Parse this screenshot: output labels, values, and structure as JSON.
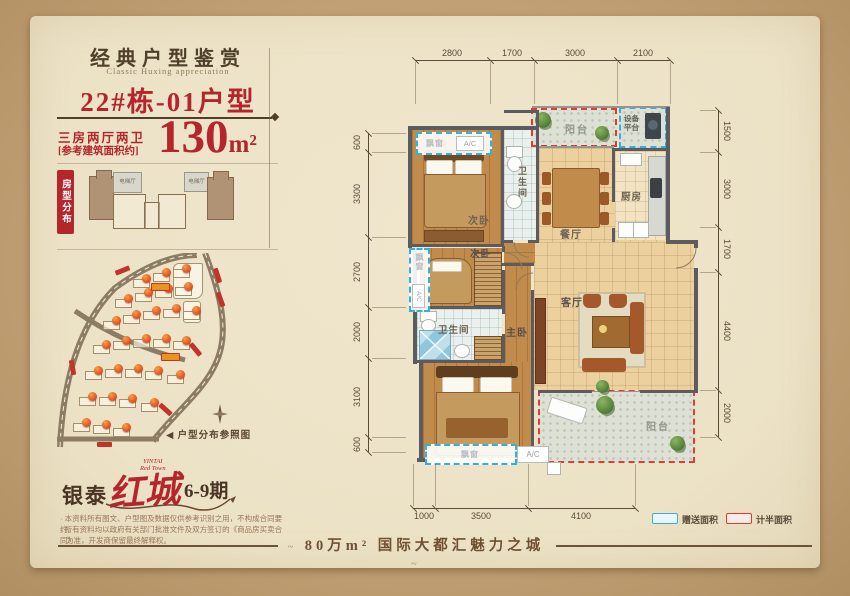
{
  "colors": {
    "accent_red": "#b5262c",
    "cyan_dash": "#34b0da",
    "red_dash": "#e23b2f",
    "panel": "#ece2c6",
    "kraft": "#c2a176"
  },
  "header": {
    "title": "经典户型鉴赏",
    "subtitle": "Classic Huxing appreciation",
    "unit_name": "22#栋-01户型"
  },
  "spec": {
    "layout": "三房两厅两卫",
    "area_note": "[参考建筑面积约]",
    "area_value": "130",
    "area_unit": "m²"
  },
  "distribution": {
    "label": "房型分布",
    "elevator": "电梯厅"
  },
  "site_map": {
    "caption": "◀ 户型分布参照图",
    "compass": "N",
    "buildings": [
      [
        78,
        26
      ],
      [
        98,
        20
      ],
      [
        118,
        16
      ],
      [
        60,
        46
      ],
      [
        80,
        40
      ],
      [
        100,
        36
      ],
      [
        120,
        34
      ],
      [
        48,
        68
      ],
      [
        68,
        62
      ],
      [
        88,
        58
      ],
      [
        108,
        56
      ],
      [
        128,
        58
      ],
      [
        38,
        92
      ],
      [
        58,
        88
      ],
      [
        78,
        86
      ],
      [
        98,
        86
      ],
      [
        118,
        88
      ],
      [
        30,
        118
      ],
      [
        50,
        116
      ],
      [
        70,
        116
      ],
      [
        90,
        118
      ],
      [
        112,
        122
      ],
      [
        24,
        144
      ],
      [
        44,
        144
      ],
      [
        64,
        146
      ],
      [
        86,
        150
      ],
      [
        18,
        170
      ],
      [
        38,
        172
      ],
      [
        58,
        175
      ]
    ]
  },
  "logo": {
    "brand": "银泰",
    "name": "红城",
    "phase": "6-9期",
    "en_line1": "YINTAI",
    "en_line2": "Red Town"
  },
  "disclaimer": {
    "line1": "· 本资料所有图文、户型图及数据仅供参考识别之用，不构成合同要约。",
    "line2": "· 所有资料均以政府有关部门批准文件及双方签订的《商品房买卖合同》",
    "line3": "为准，开发商保留最终解释权。"
  },
  "tagline": {
    "text": "80万m² 国际大都汇魅力之城",
    "flourish_left": "~",
    "flourish_right": "~"
  },
  "plan": {
    "dims": {
      "top": [
        "2800",
        "1700",
        "3000",
        "2100"
      ],
      "right": [
        "1500",
        "3000",
        "1700",
        "4400",
        "2000"
      ],
      "left": [
        "600",
        "3300",
        "2700",
        "2000",
        "3100",
        "600"
      ],
      "bottom": [
        "1000",
        "3500",
        "4100"
      ]
    },
    "rooms": {
      "balcony": "阳台",
      "equipment_line1": "设备",
      "equipment_line2": "平台",
      "kitchen": "厨房",
      "dining": "餐厅",
      "living": "客厅",
      "bedroom": "次卧",
      "master": "主卧",
      "bath": "卫生间",
      "bay_window": "飘窗",
      "ac": "A/C"
    },
    "legend": {
      "gift": "赠送面积",
      "half": "计半面积"
    }
  }
}
